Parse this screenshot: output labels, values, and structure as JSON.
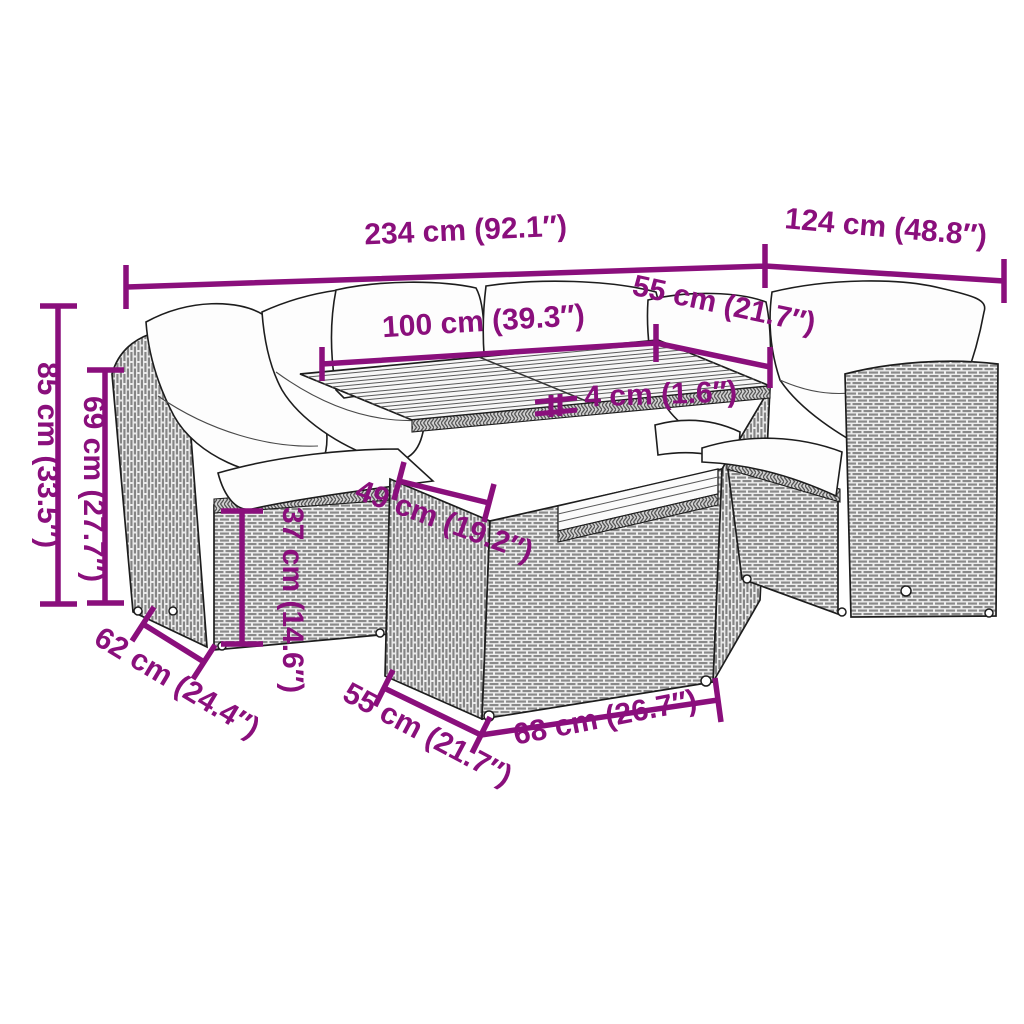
{
  "illustration": {
    "type": "product dimension diagram",
    "subject": "rattan garden lounge set with cushions and slatted-top table",
    "accent_color": "#8A0F7C",
    "line_color": "#1d1d1d"
  },
  "dimensions": {
    "overall_width": "234 cm (92.1″)",
    "right_section_depth": "124 cm (48.8″)",
    "seat_section_width": "100 cm (39.3″)",
    "tabletop_side": "55 cm (21.7″)",
    "tabletop_thickness": "4 cm (1.6″)",
    "total_height": "85 cm (33.5″)",
    "backrest_height": "69 cm (27.7″)",
    "seat_height": "37 cm (14.6″)",
    "table_clearance": "49 cm (19.2″)",
    "section_depth": "62 cm (24.4″)",
    "table_depth": "55 cm (21.7″)",
    "table_width": "68 cm (26.7″)"
  }
}
